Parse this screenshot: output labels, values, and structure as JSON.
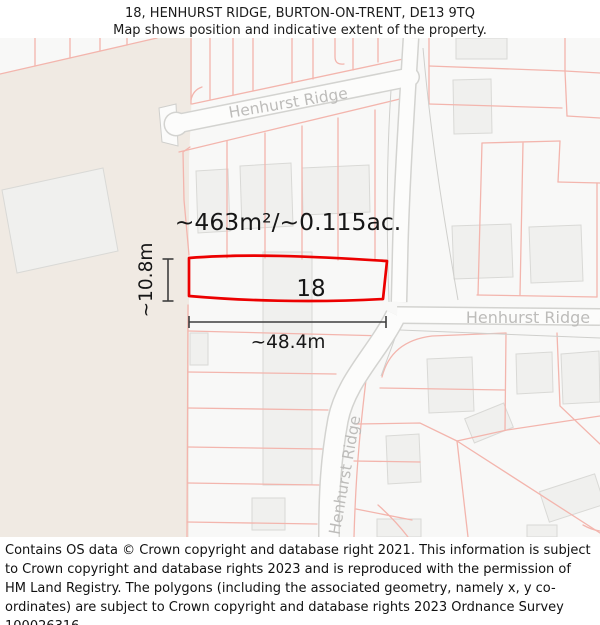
{
  "header": {
    "title": "18, HENHURST RIDGE, BURTON-ON-TRENT, DE13 9TQ",
    "subtitle": "Map shows position and indicative extent of the property."
  },
  "map": {
    "plot_number": "18",
    "area_label": "~463m²/~0.115ac.",
    "width_label": "~48.4m",
    "height_label": "~10.8m",
    "road_label_top": "Henhurst Ridge",
    "road_label_east": "Henhurst Ridge",
    "road_label_south": "Henhurst Ridge",
    "colors": {
      "plot_outline": "#ec0000",
      "parcel_line": "#f3b5ad",
      "field": "#f0eae3",
      "building": "#f0f0ee",
      "road_fill": "#fcfcfb",
      "road_casing": "#d3d3d0",
      "road_label": "#bdbcba"
    }
  },
  "footer": {
    "text": "Contains OS data © Crown copyright and database right 2021. This information is subject to Crown copyright and database rights 2023 and is reproduced with the permission of HM Land Registry. The polygons (including the associated geometry, namely x, y co-ordinates) are subject to Crown copyright and database rights 2023 Ordnance Survey 100026316."
  }
}
